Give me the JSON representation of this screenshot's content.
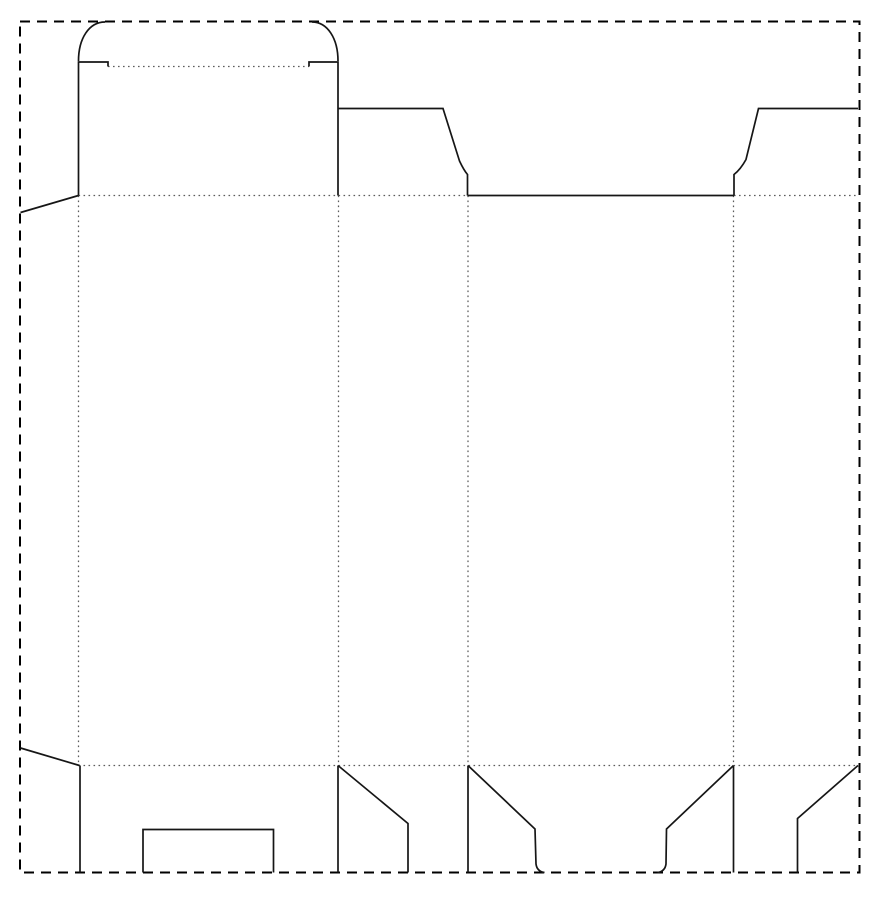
{
  "canvas": {
    "width": 880,
    "height": 900,
    "background": "#ffffff"
  },
  "styles": {
    "border": {
      "color": "#000000",
      "width": 2,
      "dash": "10 7"
    },
    "cut": {
      "color": "#161616",
      "width": 1.7,
      "dash": ""
    },
    "fold": {
      "color": "#5c5c5c",
      "width": 1.25,
      "dash": "1.6 3.4"
    }
  },
  "diagram": {
    "type": "dieline",
    "description": "carton box dieline with tuck-top lid, dust flaps and lock bottom",
    "sheet_border": {
      "x": 20,
      "y": 21.5,
      "w": 839.5,
      "h": 851
    },
    "cut_paths": [
      {
        "name": "lid-left-shoulder-edge",
        "d": "M 108 66.5 L 108 62 L 78.5 62 L 78.5 195.5"
      },
      {
        "name": "lid-left-arc",
        "d": "M 78.5 61 C 78.5 38.5 89 22 105 22"
      },
      {
        "name": "lid-right-shoulder-edge",
        "d": "M 309 66.5 L 309 62 L 338 62 L 338 195.5"
      },
      {
        "name": "lid-right-arc",
        "d": "M 338 61 C 338 38.5 327.5 22 312 22"
      },
      {
        "name": "glue-flap-top-cut",
        "d": "M 78.5 195.5 L 20.5 212.5"
      },
      {
        "name": "glue-flap-bottom-cut",
        "d": "M 20.5 748 L 79.5 765.5"
      },
      {
        "name": "dust-flap-left-cut",
        "d": "M 338 108.5 L 443 108.5 L 459.5 161 Q 464 170.5 467.5 174.5 L 467.5 195.5"
      },
      {
        "name": "back-panel-top-cut",
        "d": "M 467.5 195.5 L 734 195.5"
      },
      {
        "name": "dust-flap-right-cut",
        "d": "M 858 108.5 L 758.5 108.5 L 746 159.5 Q 740.5 169.5 734 174.5 L 734 195.5"
      },
      {
        "name": "bottom-a-left-cut",
        "d": "M 80 765.5 L 80 872.5"
      },
      {
        "name": "bottom-a-notch-cut",
        "d": "M 143 872.5 L 143 829.5 L 273.5 829.5 L 273.5 872.5"
      },
      {
        "name": "bottom-a-right-cut",
        "d": "M 338 765.5 L 338 872.5"
      },
      {
        "name": "bottom-b-diagonal-cut",
        "d": "M 338 765.5 L 408 823.5 L 408 872.5"
      },
      {
        "name": "bottom-b-right-cut",
        "d": "M 468 765.5 L 468 872.5"
      },
      {
        "name": "bottom-c-left-cut",
        "d": "M 468 765.5 L 535 829 L 536 864 Q 537 871.5 544.5 872.5"
      },
      {
        "name": "bottom-c-right-cut",
        "d": "M 733.5 765.5 L 666.5 829 L 666 864 Q 665 871.5 657.5 872.5"
      },
      {
        "name": "bottom-d-left-cut",
        "d": "M 733.5 765.5 L 733.5 872.5"
      },
      {
        "name": "bottom-d-diagonal-cut",
        "d": "M 858 765.5 L 797.5 818.5 L 797.5 872.5"
      }
    ],
    "fold_lines": [
      {
        "name": "lid-fold",
        "x1": 108,
        "y1": 66.5,
        "x2": 309,
        "y2": 66.5
      },
      {
        "name": "top-fold-left",
        "x1": 78.5,
        "y1": 195.5,
        "x2": 467.5,
        "y2": 195.5
      },
      {
        "name": "top-fold-right",
        "x1": 734,
        "y1": 195.5,
        "x2": 858,
        "y2": 195.5
      },
      {
        "name": "bottom-fold",
        "x1": 78.5,
        "y1": 765.5,
        "x2": 858,
        "y2": 765.5
      },
      {
        "name": "glue-flap-fold",
        "x1": 78.5,
        "y1": 195.5,
        "x2": 78.5,
        "y2": 765.5
      },
      {
        "name": "panel-ab-fold",
        "x1": 338.5,
        "y1": 195.5,
        "x2": 338.5,
        "y2": 765.5
      },
      {
        "name": "panel-bc-fold",
        "x1": 468,
        "y1": 195.5,
        "x2": 468,
        "y2": 765.5
      },
      {
        "name": "panel-cd-fold",
        "x1": 733.5,
        "y1": 195.5,
        "x2": 733.5,
        "y2": 765.5
      }
    ]
  }
}
